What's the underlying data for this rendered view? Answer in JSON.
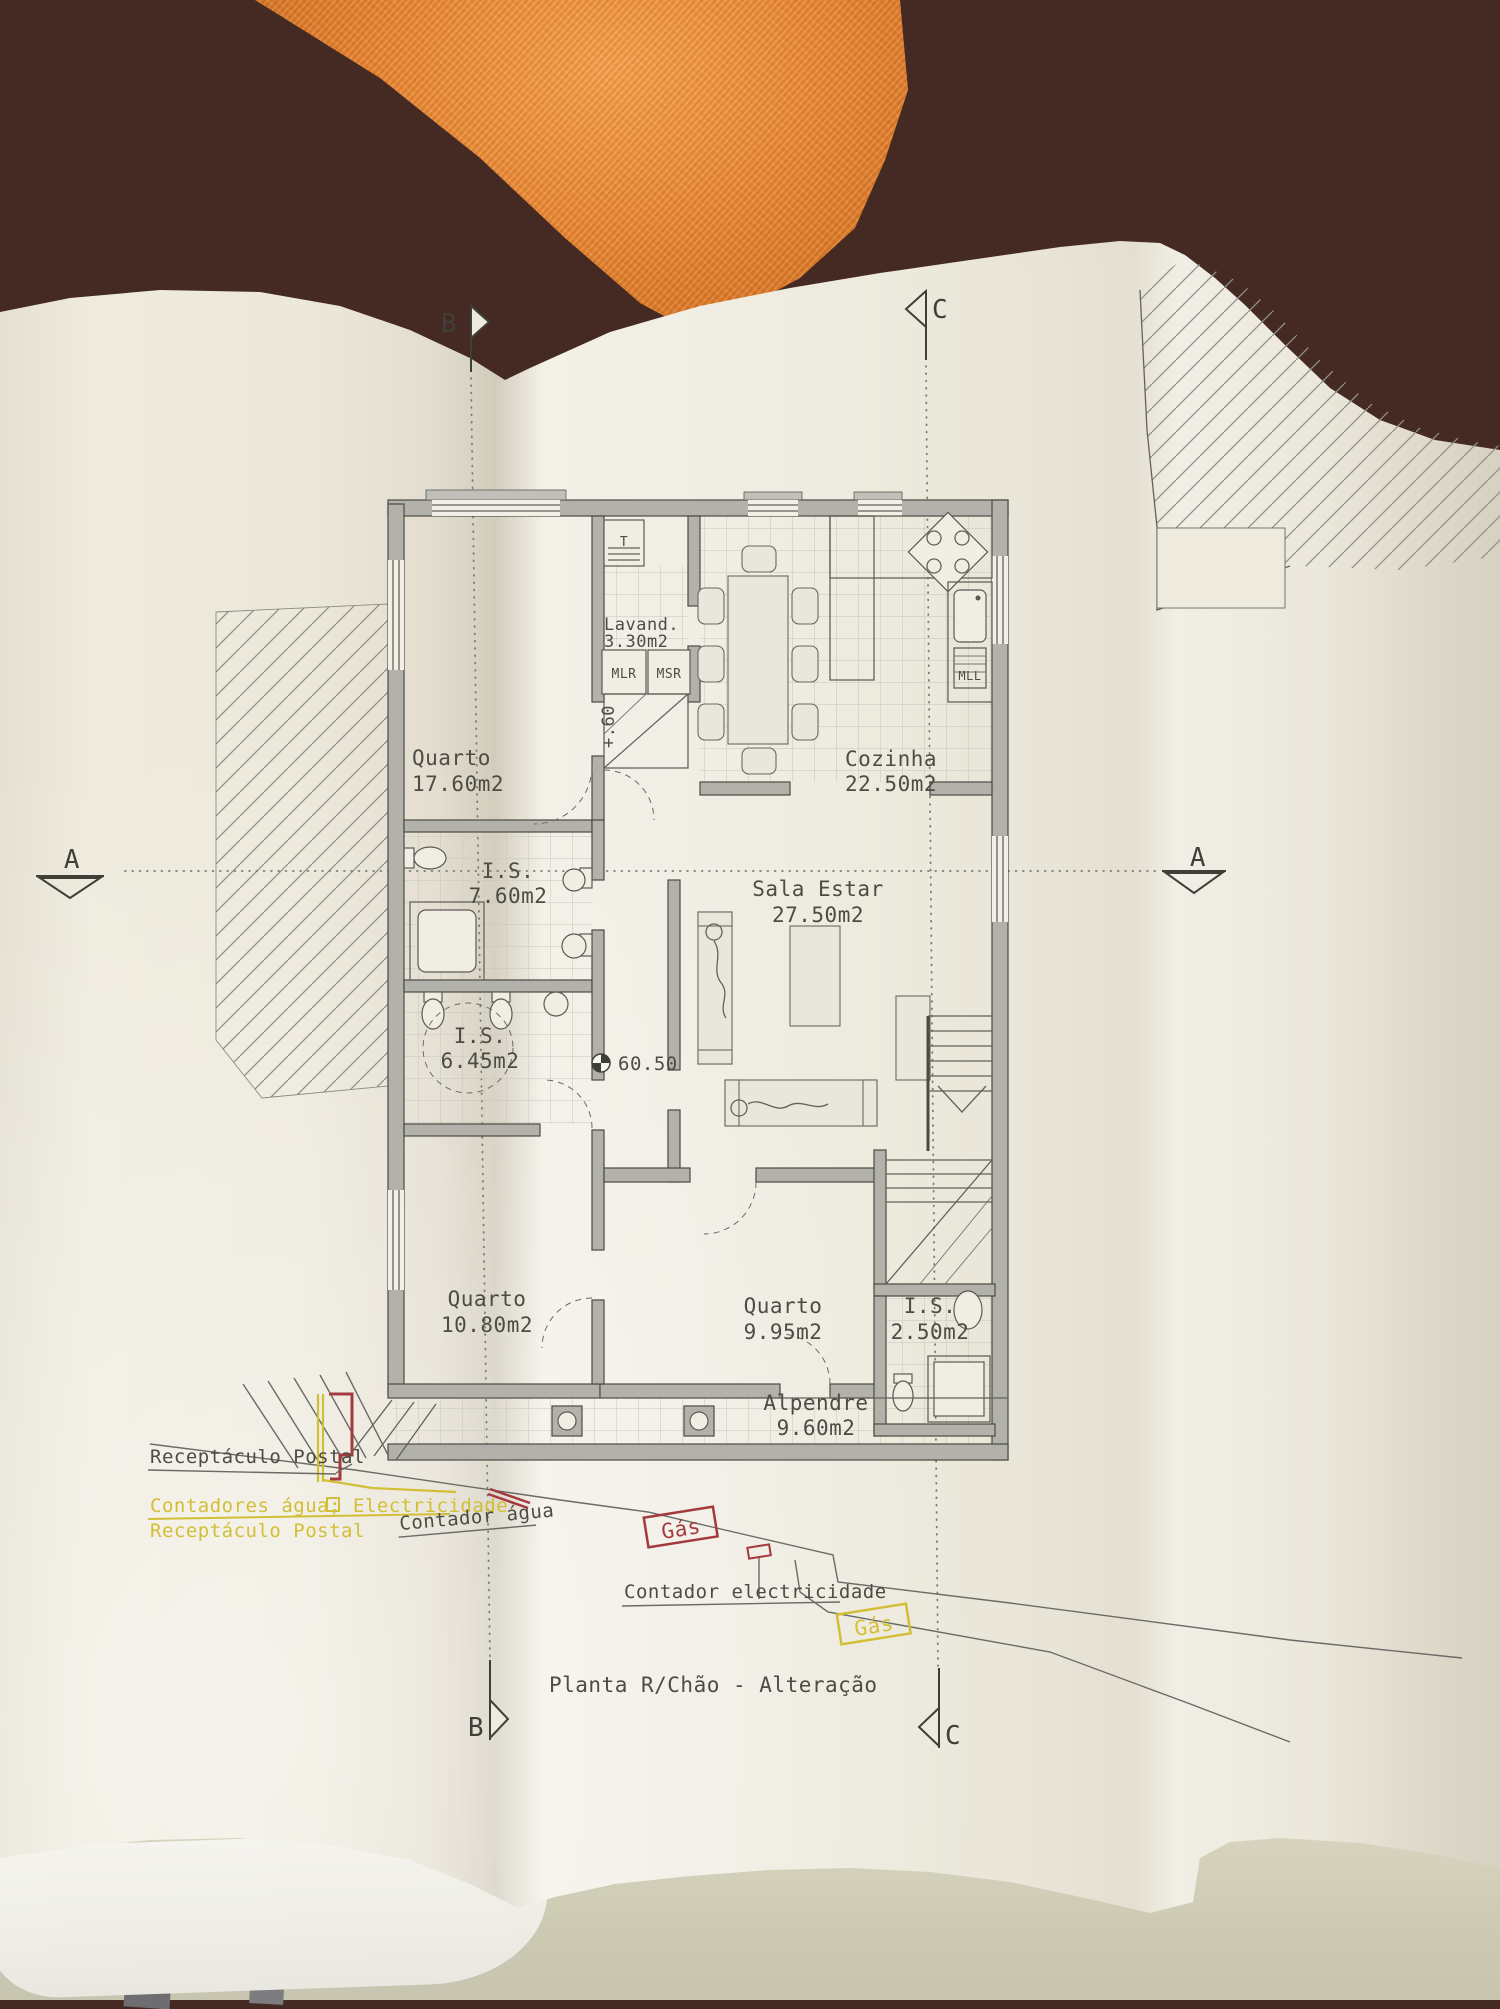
{
  "scene": {
    "background_color": "#442a22",
    "towel_color": "#e07d28",
    "paper_color": "#efebe0",
    "table_color": "#d2cfba"
  },
  "plan": {
    "title": "Planta R/Chão - Alteração",
    "rooms": [
      {
        "name": "Quarto",
        "area": "17.60m2"
      },
      {
        "name": "Lavand.",
        "area": "3.30m2"
      },
      {
        "name": "Cozinha",
        "area": "22.50m2"
      },
      {
        "name": "I.S.",
        "area": "7.60m2"
      },
      {
        "name": "Sala Estar",
        "area": "27.50m2"
      },
      {
        "name": "I.S.",
        "area": "6.45m2"
      },
      {
        "name": "Quarto",
        "area": "10.80m2"
      },
      {
        "name": "Quarto",
        "area": "9.95m2"
      },
      {
        "name": "I.S.",
        "area": "2.50m2"
      },
      {
        "name": "Alpendre",
        "area": "9.60m2"
      }
    ],
    "appliances": {
      "t": "T",
      "mlr": "MLR",
      "msr": "MSR",
      "mll": "MLL"
    },
    "levels": {
      "step": "+.60",
      "ground": "60.50"
    },
    "sections": {
      "b": "B",
      "c": "C",
      "a": "A"
    },
    "notes": {
      "postal_existing": "Receptáculo Postal",
      "meters_new": "Contadores água; Electricidade",
      "postal_new": "Receptáculo Postal",
      "water_meter": "Contador água",
      "gas_upper": "Gás",
      "electricity_meter": "Contador electricidade",
      "gas_lower": "Gás"
    },
    "ink": {
      "gray": "#55554f",
      "yellow": "#d2bf35",
      "red": "#a43a3e"
    }
  }
}
